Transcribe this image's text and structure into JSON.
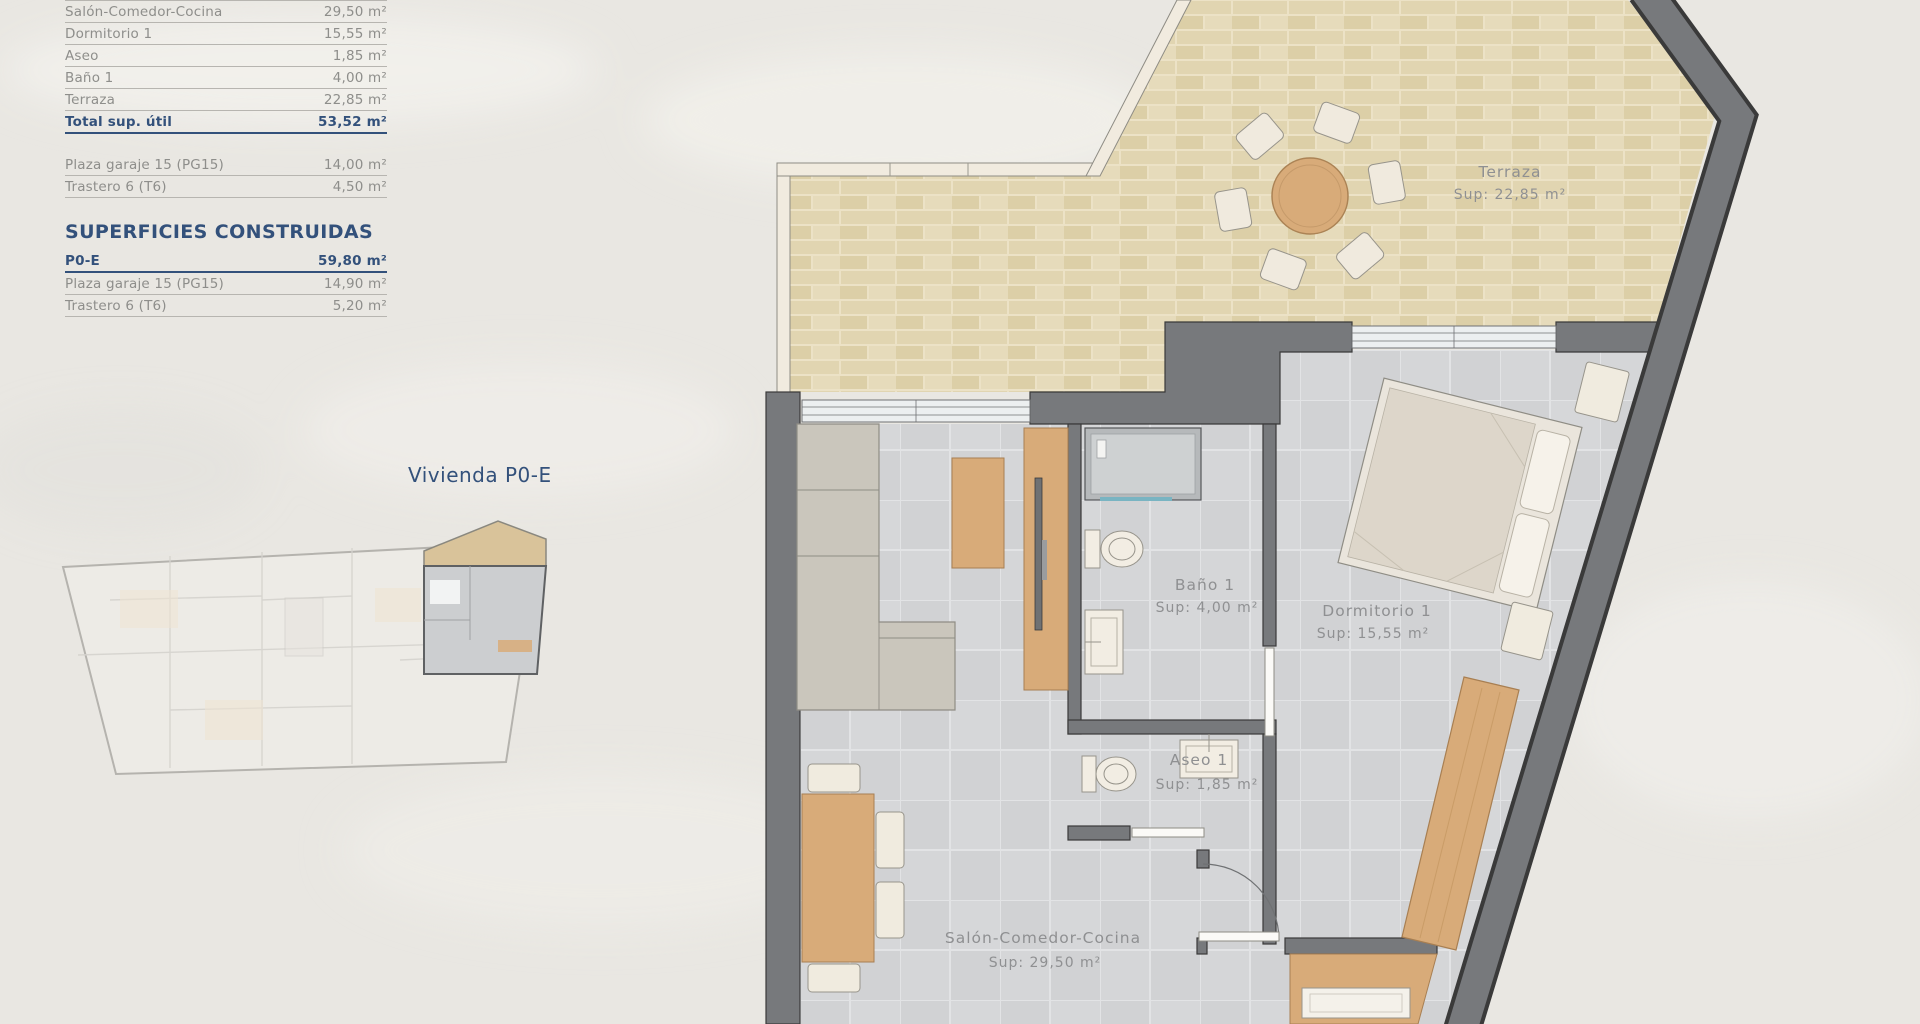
{
  "panel": {
    "useful": {
      "rows": [
        {
          "label": "Salón-Comedor-Cocina",
          "value": "29,50 m²"
        },
        {
          "label": "Dormitorio 1",
          "value": "15,55 m²"
        },
        {
          "label": "Aseo",
          "value": "1,85 m²"
        },
        {
          "label": "Baño 1",
          "value": "4,00 m²"
        },
        {
          "label": "Terraza",
          "value": "22,85 m²"
        }
      ],
      "total": {
        "label": "Total sup. útil",
        "value": "53,52 m²"
      },
      "extras": [
        {
          "label": "Plaza garaje 15 (PG15)",
          "value": "14,00 m²"
        },
        {
          "label": "Trastero 6 (T6)",
          "value": "4,50 m²"
        }
      ]
    },
    "built": {
      "heading": "SUPERFICIES CONSTRUIDAS",
      "total": {
        "label": "P0-E",
        "value": "59,80 m²"
      },
      "rows": [
        {
          "label": "Plaza garaje 15 (PG15)",
          "value": "14,90 m²"
        },
        {
          "label": "Trastero 6 (T6)",
          "value": "5,20 m²"
        }
      ]
    },
    "unit_label": "Vivienda P0-E"
  },
  "plan": {
    "terraza": {
      "name": "Terraza",
      "sup": "Sup: 22,85 m²"
    },
    "bano": {
      "name": "Baño 1",
      "sup": "Sup: 4,00 m²"
    },
    "dormitorio": {
      "name": "Dormitorio 1",
      "sup": "Sup: 15,55 m²"
    },
    "aseo": {
      "name": "Aseo 1",
      "sup": "Sup: 1,85 m²"
    },
    "salon": {
      "name": "Salón-Comedor-Cocina",
      "sup": "Sup: 29,50 m²"
    }
  },
  "colors": {
    "navy": "#33517b",
    "row_text": "#8e8e8b",
    "wall_gray": "#77797c",
    "terrace_brick": "#e1d5b1",
    "floor_tile": "#d2d3d5",
    "wood": "#d8ab79",
    "background": "#e9e7e2"
  }
}
